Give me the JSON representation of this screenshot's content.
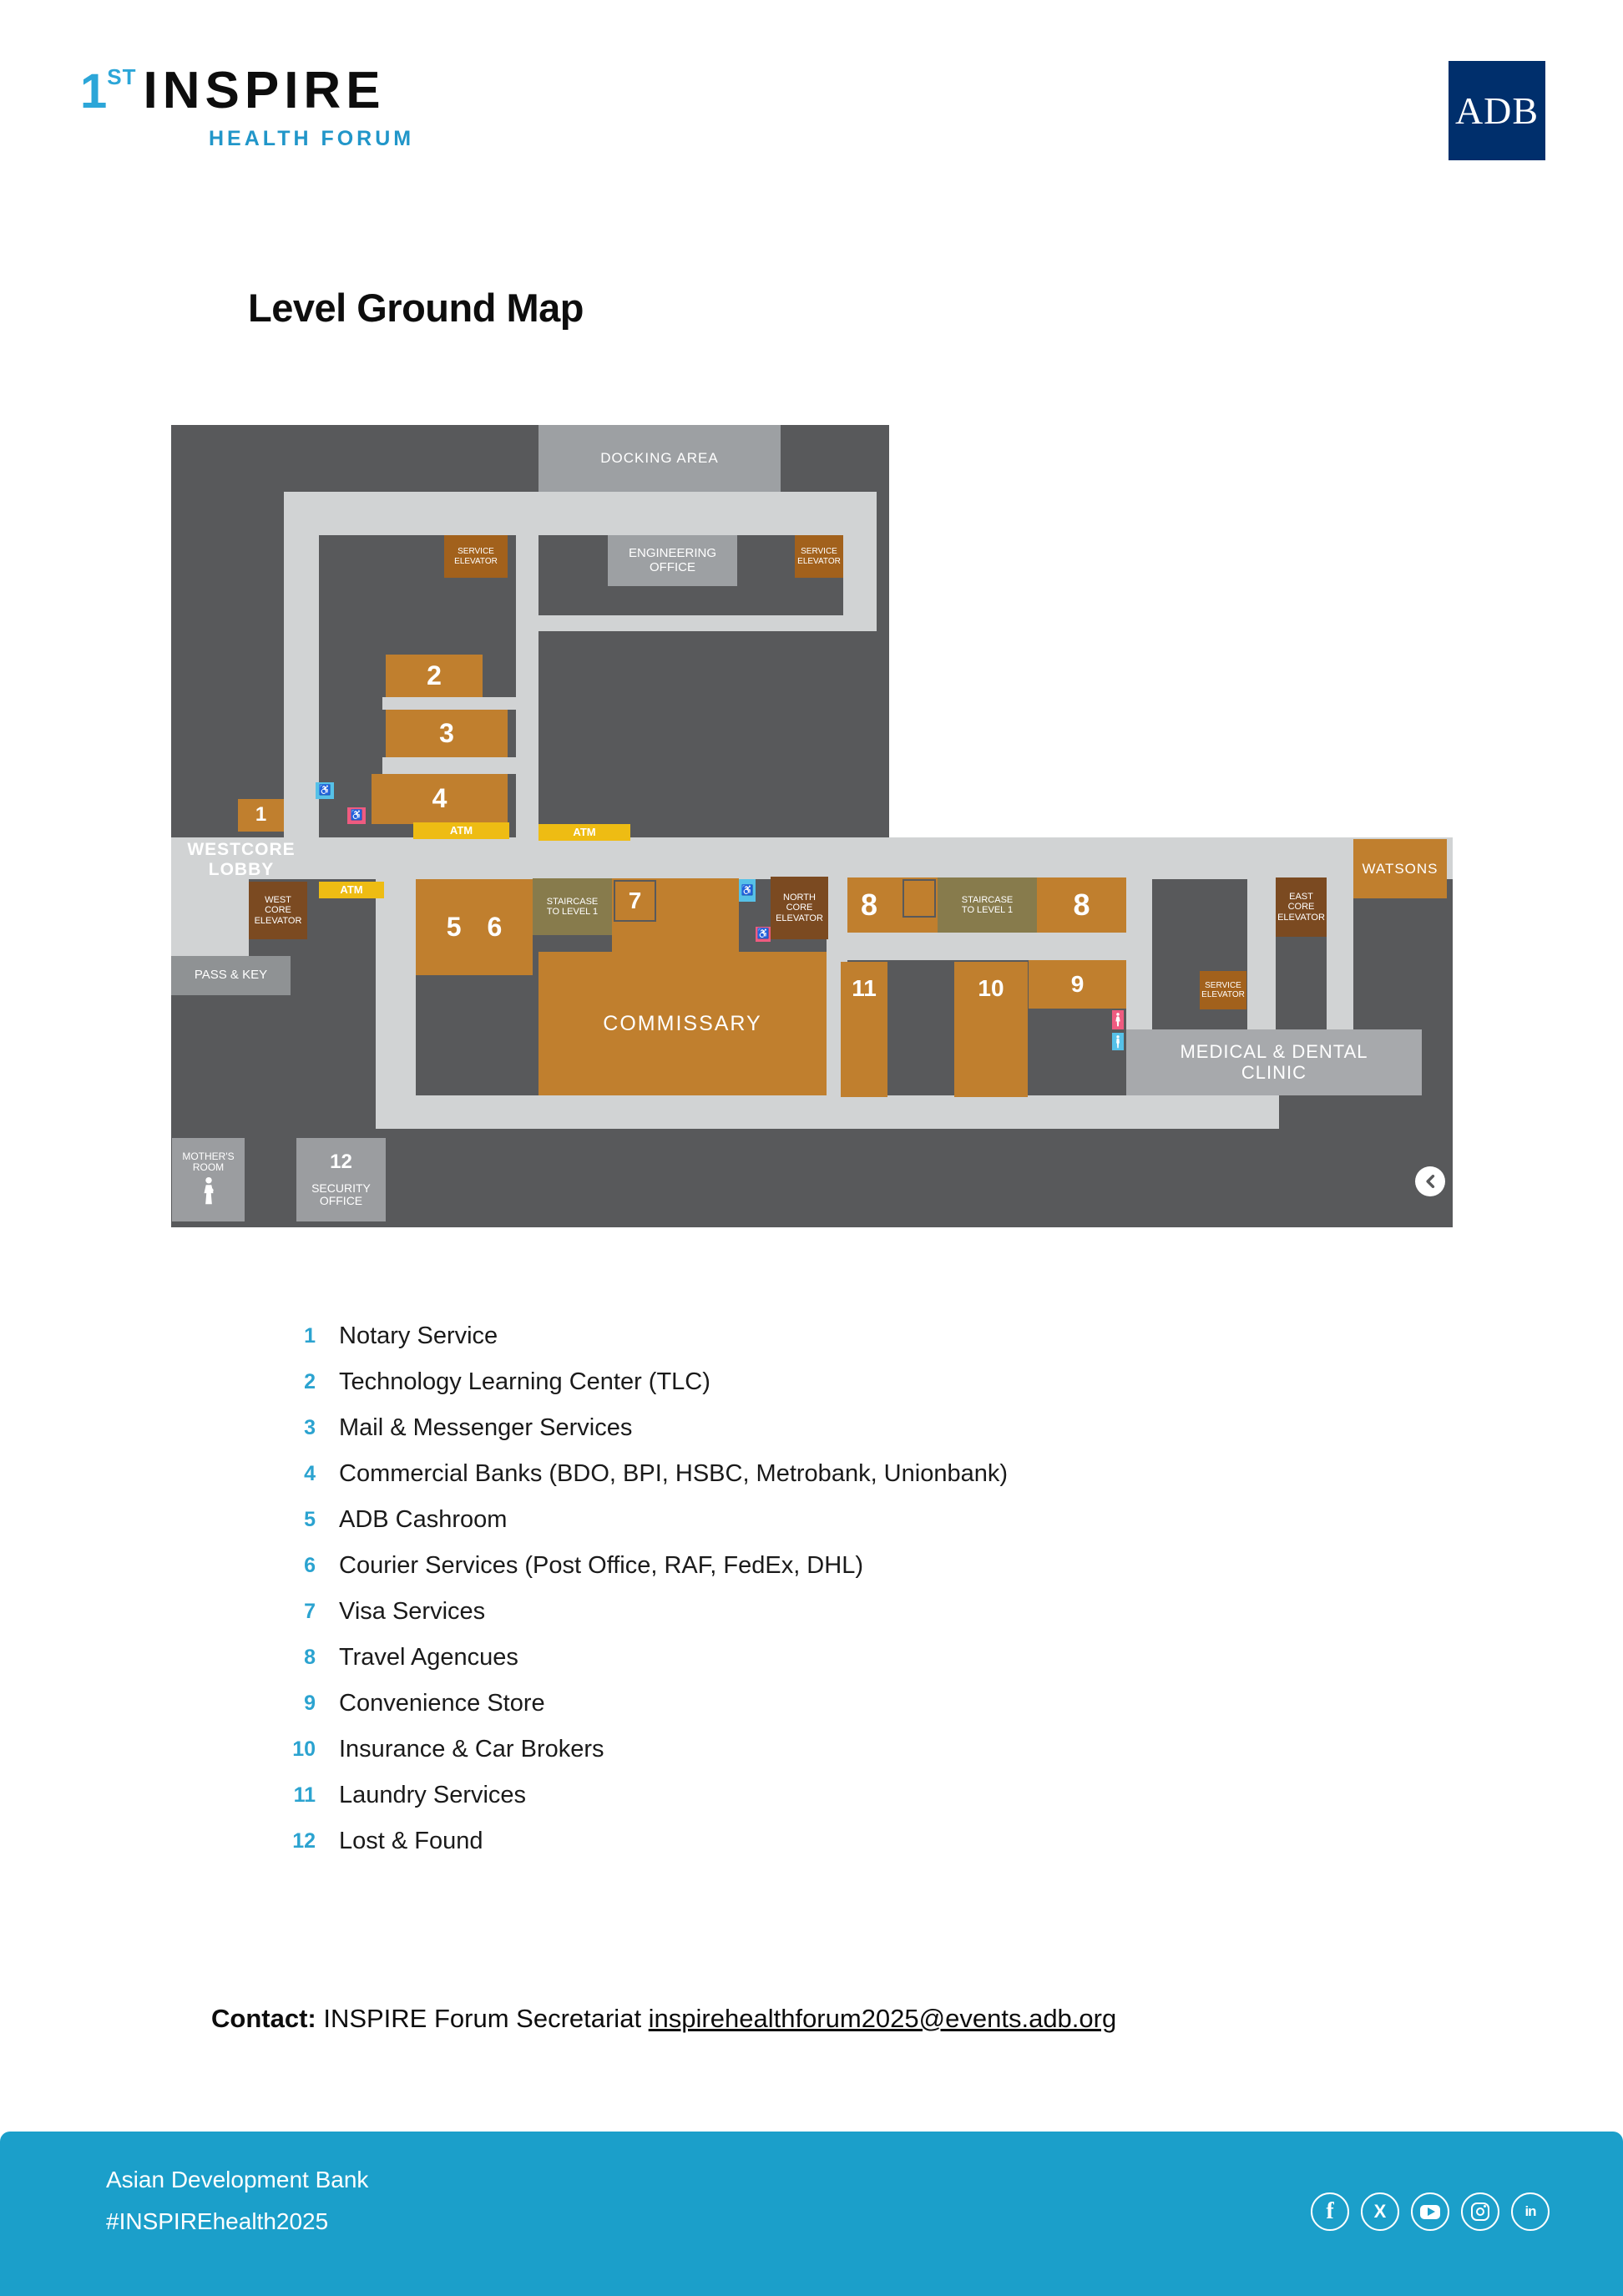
{
  "header": {
    "logo_num": "1",
    "logo_sup": "ST",
    "logo_main": "INSPIRE",
    "logo_sub": "HEALTH FORUM",
    "adb": "ADB"
  },
  "title": "Level Ground Map",
  "map": {
    "labels": {
      "docking": "DOCKING AREA",
      "engineering": "ENGINEERING\nOFFICE",
      "service_elevator": "SERVICE\nELEVATOR",
      "room1": "1",
      "room2": "2",
      "room3": "3",
      "room4": "4",
      "atm": "ATM",
      "westcore": "WESTCORE\nLOBBY",
      "west_core_elevator": "WEST\nCORE\nELEVATOR",
      "pass_key": "PASS & KEY",
      "room56": "5 6",
      "staircase": "STAIRCASE\nTO LEVEL 1",
      "room7": "7",
      "commissary": "COMMISSARY",
      "north_core_elevator": "NORTH\nCORE\nELEVATOR",
      "room8": "8",
      "east_core_elevator": "EAST\nCORE\nELEVATOR",
      "watsons": "WATSONS",
      "room9": "9",
      "room10": "10",
      "room11": "11",
      "clinic": "MEDICAL & DENTAL\nCLINIC",
      "mothers": "MOTHER'S\nROOM",
      "room12": "12",
      "security": "SECURITY\nOFFICE"
    }
  },
  "legend": {
    "items": [
      {
        "num": "1",
        "label": "Notary Service"
      },
      {
        "num": "2",
        "label": "Technology Learning Center (TLC)"
      },
      {
        "num": "3",
        "label": "Mail & Messenger Services"
      },
      {
        "num": "4",
        "label": "Commercial Banks (BDO, BPI, HSBC, Metrobank, Unionbank)"
      },
      {
        "num": "5",
        "label": "ADB Cashroom"
      },
      {
        "num": "6",
        "label": "Courier Services (Post Office, RAF, FedEx, DHL)"
      },
      {
        "num": "7",
        "label": "Visa Services"
      },
      {
        "num": "8",
        "label": "Travel Agencues"
      },
      {
        "num": "9",
        "label": "Convenience Store"
      },
      {
        "num": "10",
        "label": "Insurance & Car Brokers"
      },
      {
        "num": "11",
        "label": "Laundry Services"
      },
      {
        "num": "12",
        "label": "Lost & Found"
      }
    ]
  },
  "contact": {
    "prefix": "Contact:",
    "body": " INSPIRE Forum Secretariat ",
    "email": "inspirehealthforum2025@events.adb.org"
  },
  "footer": {
    "line1": "Asian Development Bank",
    "line2": "#INSPIREhealth2025",
    "social": [
      {
        "name": "facebook",
        "glyph": "f"
      },
      {
        "name": "x",
        "glyph": "X"
      },
      {
        "name": "youtube",
        "glyph": ""
      },
      {
        "name": "instagram",
        "glyph": ""
      },
      {
        "name": "linkedin",
        "glyph": "in"
      }
    ]
  },
  "colors": {
    "accent_blue": "#2ca6d8",
    "legend_number_blue": "#2ba3d0",
    "adb_navy": "#002f6c",
    "footer_teal": "#1b9fca",
    "map_dark": "#58595b",
    "map_corridor": "#d1d3d4",
    "map_gray": "#9da0a3",
    "room_orange": "#c07f2e",
    "elevator_brown": "#7b4a21",
    "service_elevator_brown": "#a2611c",
    "staircase_olive": "#877b4c",
    "atm_yellow": "#eebc13",
    "restroom_blue": "#56c1e8",
    "restroom_pink": "#ef5b80"
  }
}
